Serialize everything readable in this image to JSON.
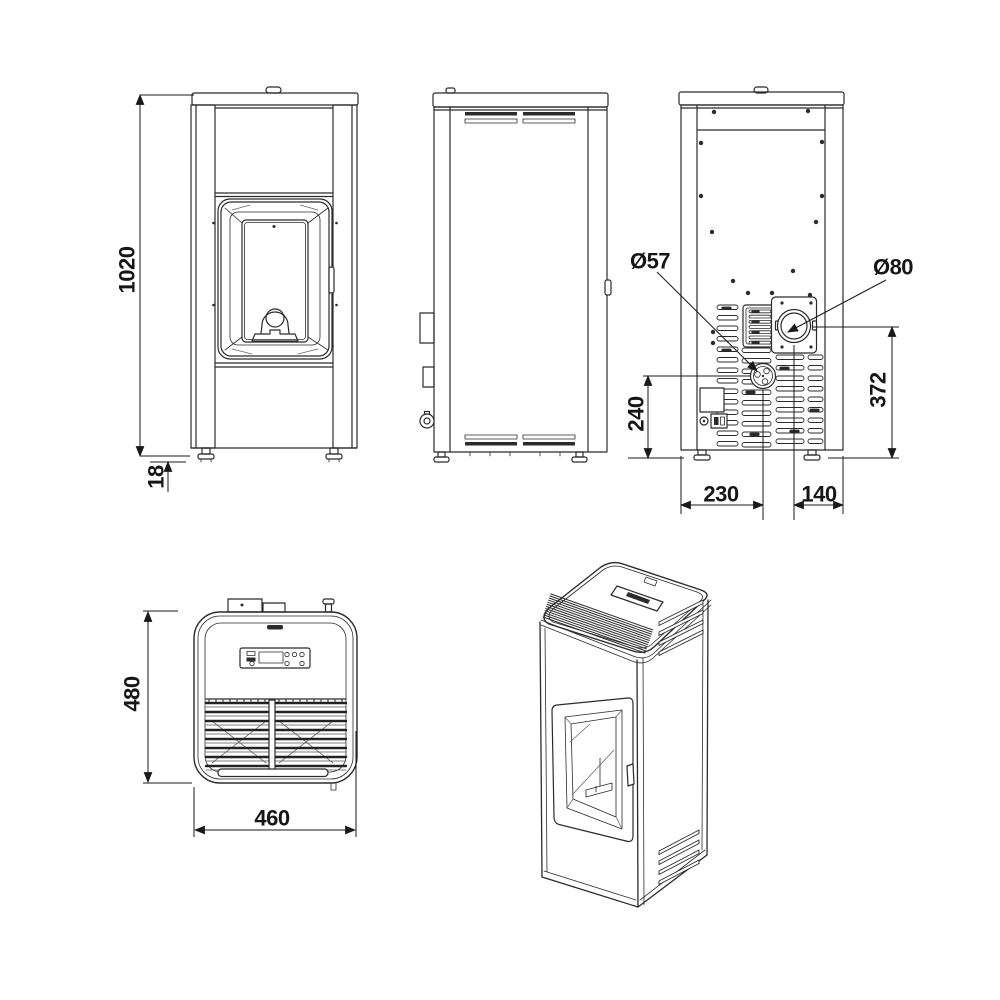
{
  "drawing": {
    "background": "#ffffff",
    "line_color": "#2b2b2b",
    "dimension_color": "#1a1a1a"
  },
  "dimensions": {
    "front": {
      "overall_height": "1020",
      "foot_height": "18"
    },
    "rear": {
      "intake_diameter": "Ø57",
      "flue_diameter": "Ø80",
      "intake_center_height": "240",
      "flue_center_height": "372",
      "intake_center_from_left": "230",
      "flue_center_from_right": "140"
    },
    "top": {
      "depth": "480",
      "width": "460"
    }
  }
}
